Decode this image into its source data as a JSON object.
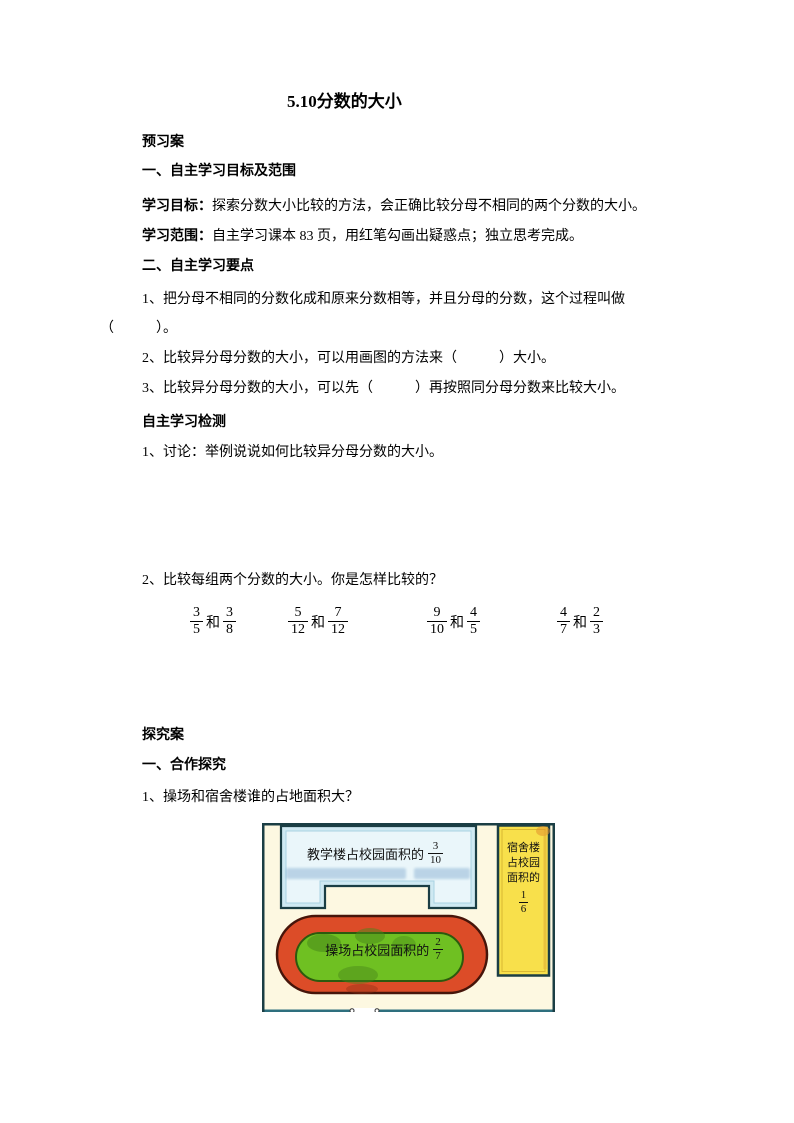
{
  "doc": {
    "title": "5.10分数的大小",
    "paragraphs": {
      "preview_heading": "预习案",
      "sec1_heading": "一、自主学习目标及范围",
      "goal_label": "学习目标：",
      "goal_text": "探索分数大小比较的方法，会正确比较分母不相同的两个分数的大小。",
      "scope_label": "学习范围：",
      "scope_text": "自主学习课本 83 页，用红笔勾画出疑惑点；独立思考完成。",
      "sec2_heading": "二、自主学习要点",
      "item1_line1": "1、把分母不相同的分数化成和原来分数相等，并且分母的分数，这个过程叫做",
      "item1_line2": "（　　　）。",
      "item2": "2、比较异分母分数的大小，可以用画图的方法来（　　　）大小。",
      "item3": "3、比较异分母分数的大小，可以先（　　　）再按照同分母分数来比较大小。",
      "check_heading": "自主学习检测",
      "check_item1": "1、讨论：举例说说如何比较异分母分数的大小。",
      "check_item2": "2、比较每组两个分数的大小。你是怎样比较的？",
      "explore_heading": "探究案",
      "coop_heading": "一、合作探究",
      "coop_item1": "1、操场和宿舍楼谁的占地面积大？"
    },
    "fraction_groups": [
      {
        "a_num": "3",
        "a_den": "5",
        "conn": "和",
        "b_num": "3",
        "b_den": "8"
      },
      {
        "a_num": "5",
        "a_den": "12",
        "conn": "和",
        "b_num": "7",
        "b_den": "12"
      },
      {
        "a_num": "9",
        "a_den": "10",
        "conn": "和",
        "b_num": "4",
        "b_den": "5"
      },
      {
        "a_num": "4",
        "a_den": "7",
        "conn": "和",
        "b_num": "2",
        "b_den": "3"
      }
    ],
    "diagram": {
      "teaching_label": "教学楼占校园面积的",
      "teaching_frac": {
        "num": "3",
        "den": "10"
      },
      "track_label": "操场占校园面积的",
      "track_frac": {
        "num": "2",
        "den": "7"
      },
      "dorm_lines": [
        "宿舍楼",
        "占校园",
        "面积的"
      ],
      "dorm_frac": {
        "num": "1",
        "den": "6"
      },
      "colors": {
        "campus_bg": "#fdf8e1",
        "map_border": "#1b3e44",
        "bottom_border": "#2e6f7e",
        "building_fill": "#cfe9f2",
        "building_inner": "#eaf6fa",
        "track_red": "#dc4c28",
        "track_outline": "#46150a",
        "field_green": "#6fc022",
        "field_outline": "#2c5a0e",
        "dorm_yellow": "#f8e04b",
        "watermark_blue": "#5b8fc0"
      }
    }
  }
}
